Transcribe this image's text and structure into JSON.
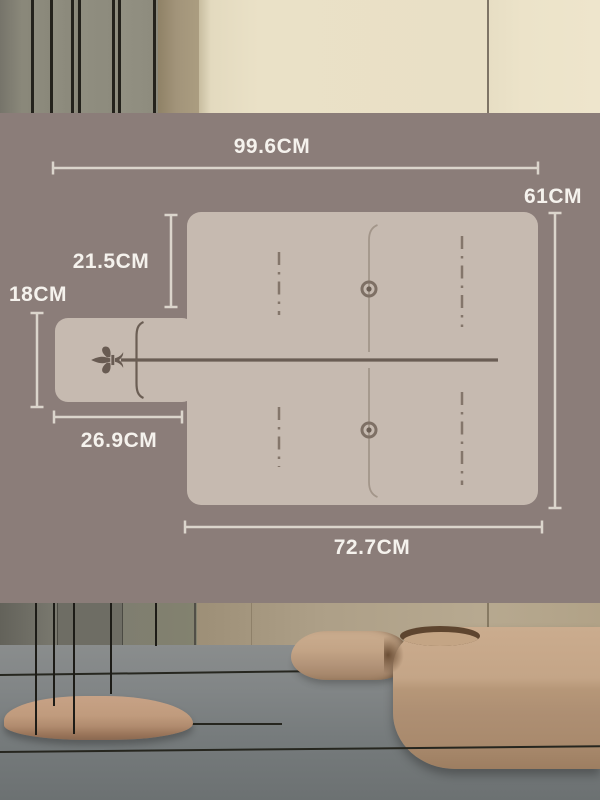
{
  "scene": {
    "type": "product-dimension-diagram",
    "product": "paddle cutting board size chart over interior photo"
  },
  "diagram": {
    "labels": {
      "total_width": "99.6CM",
      "board_height": "61CM",
      "top_to_handle": "21.5CM",
      "handle_height": "18CM",
      "handle_length": "26.9CM",
      "board_width": "72.7CM"
    },
    "colors": {
      "overlay_background": "#8b7d79",
      "board_fill": "#c6bab0",
      "dimension_line": "#dbd5cc",
      "label_text": "#f5f2ed",
      "ink": "#685b52"
    },
    "icons": [
      "fleur-de-lis-icon",
      "rivet-icon",
      "bracket-icon"
    ]
  }
}
